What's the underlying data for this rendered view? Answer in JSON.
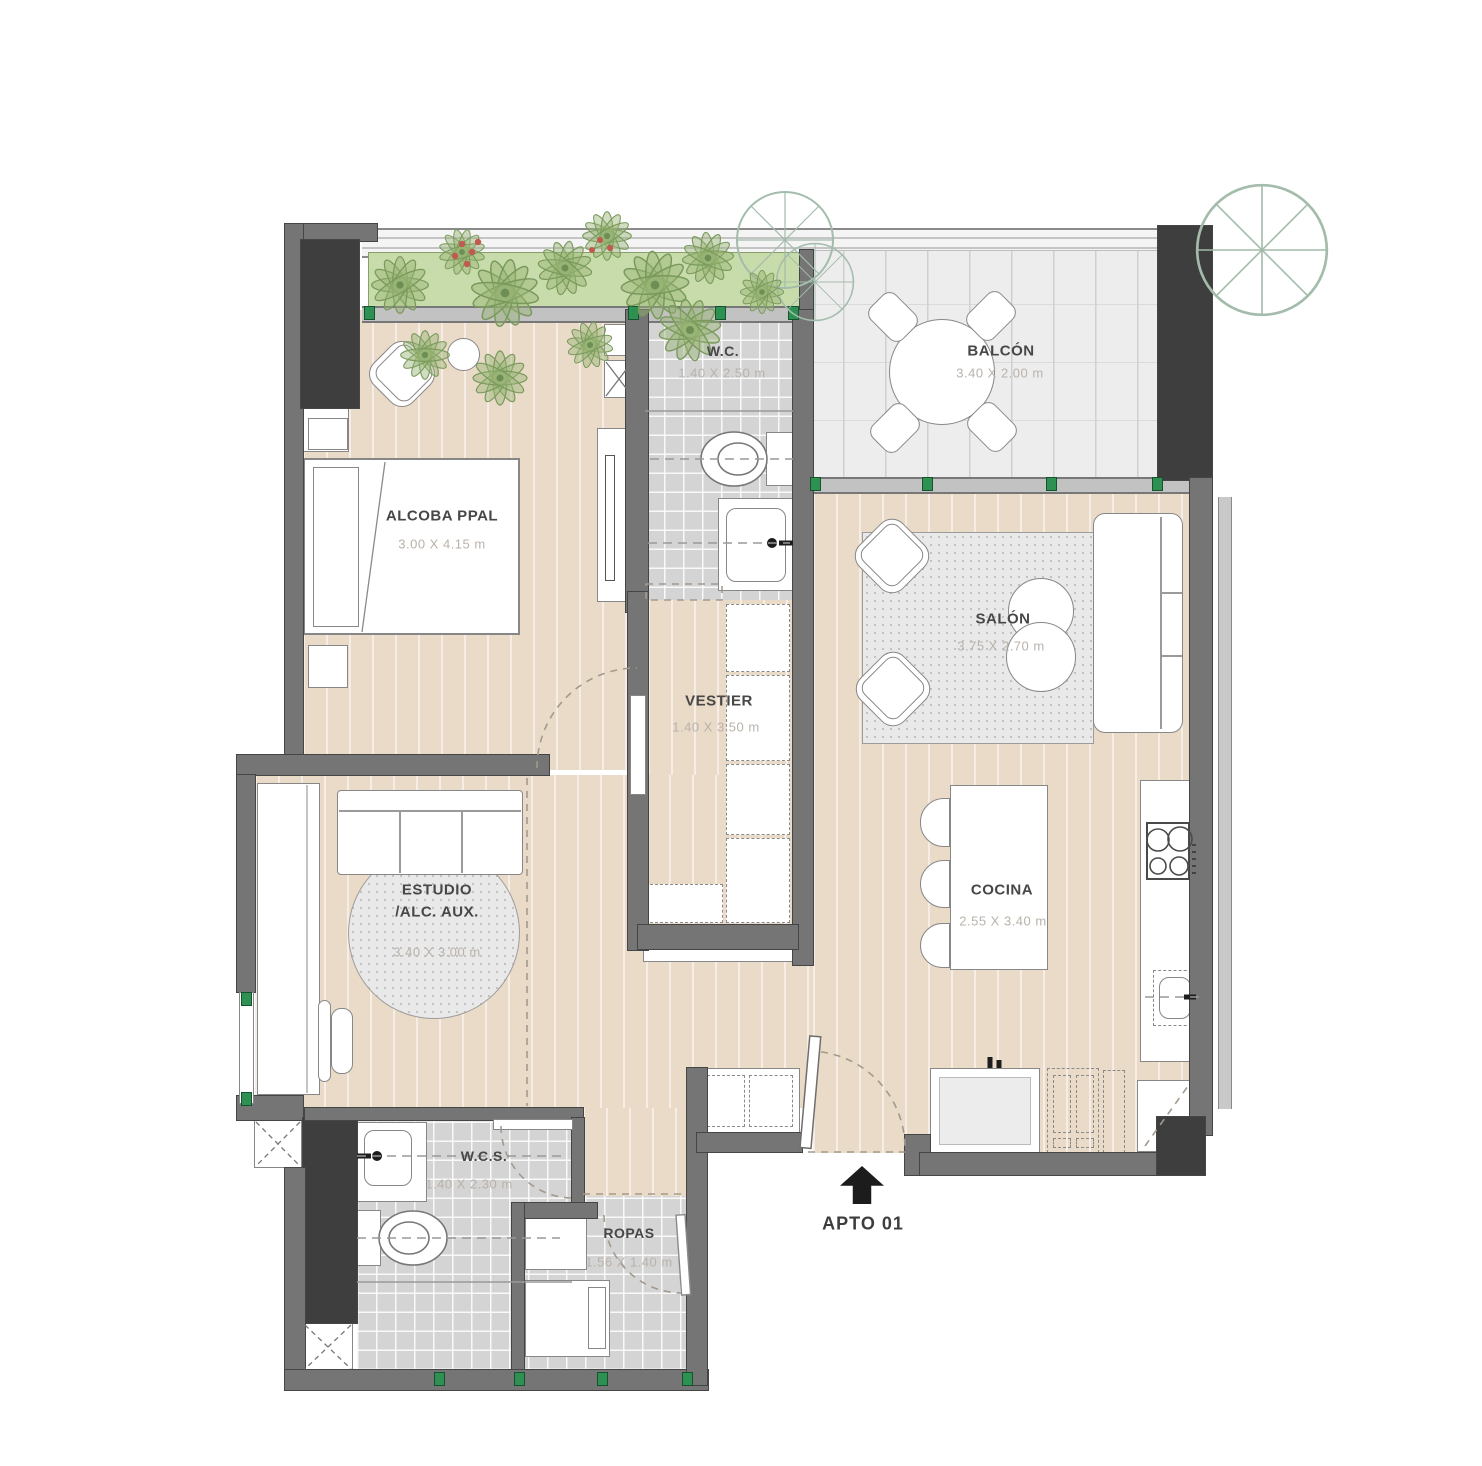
{
  "plan": {
    "apartment": {
      "label": "APTO 01"
    },
    "rooms": {
      "alcoba": {
        "label": "ALCOBA PPAL",
        "dims": "3.00 X 4.15 m"
      },
      "wc": {
        "label": "W.C.",
        "dims": "1.40 X 2.50 m"
      },
      "balcon": {
        "label": "BALCÓN",
        "dims": "3.40 X 2.00 m"
      },
      "salon": {
        "label": "SALÓN",
        "dims": "3.75 X 2.70 m"
      },
      "vestier": {
        "label": "VESTIER",
        "dims": "1.40 X 3.50 m"
      },
      "estudio": {
        "label": "ESTUDIO",
        "label2": "/ALC. AUX.",
        "dims": "3.40 X 3.00 m"
      },
      "cocina": {
        "label": "COCINA",
        "dims": "2.55 X 3.40 m"
      },
      "wcs": {
        "label": "W.C.S.",
        "dims": "1.40 X 2.30 m"
      },
      "ropas": {
        "label": "ROPAS",
        "dims": "1.56 X 1.40 m"
      }
    },
    "icons": {
      "entrance_arrow": "entrance-arrow-icon",
      "duct": "duct-x-icon",
      "stove": "stove-icon",
      "sink": "sink-icon",
      "toilet": "toilet-icon"
    },
    "colors": {
      "wall": "#757575",
      "column": "#3e3e3e",
      "wood_floor": "#eadac8",
      "bath_tile": "#d4d4d4",
      "balcony_tile": "#ededed",
      "planter_green": "#c8dcab",
      "window_marker_green": "#2e9152",
      "label_text": "#474747",
      "dims_text": "#b9b2aa"
    }
  }
}
